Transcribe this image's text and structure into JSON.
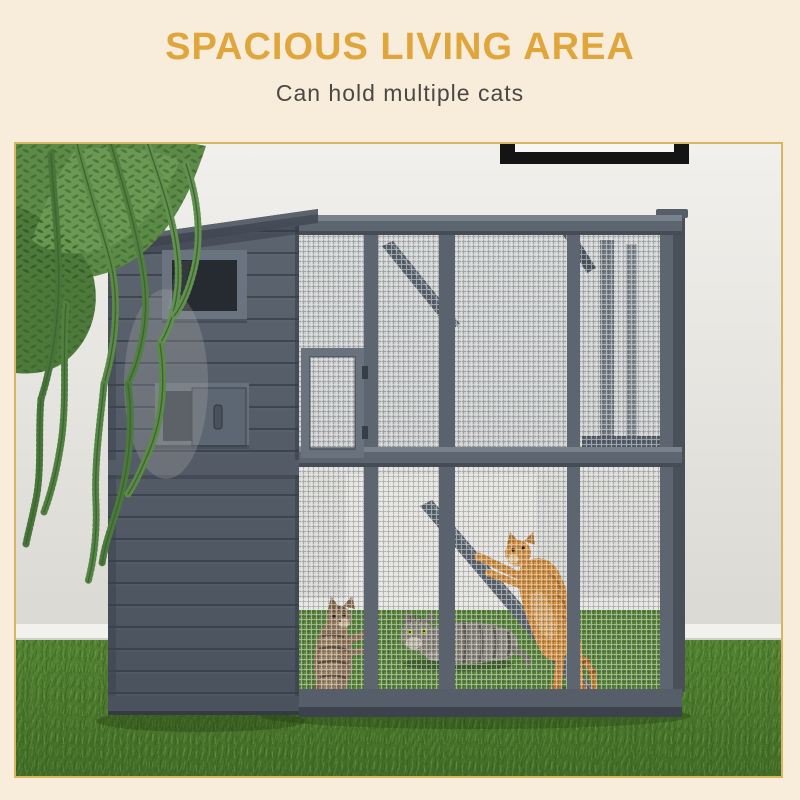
{
  "header": {
    "title": "SPACIOUS LIVING AREA",
    "subtitle": "Can hold multiple cats"
  },
  "colors": {
    "background": "#F8EDDA",
    "title": "#E0A63C",
    "subtitle": "#4B4745",
    "photo_border": "#D9B562",
    "wall": "#E9E8E3",
    "baseboard": "#F2F1ED",
    "wood_gray": "#525A66",
    "roof_gray": "#434A54",
    "mesh_wire": "#B8BDC2",
    "grass_green": "#4E7C30",
    "plant_green": "#5C8A47",
    "picture_frame": "#141414",
    "cat_orange": "#D8913F",
    "cat_brown_tabby": "#97795B",
    "cat_gray_tabby": "#8D887A",
    "latch_brass": "#B5974F"
  },
  "photo": {
    "alt": "Gray wooden catio with wire-mesh run standing on artificial grass against a light wall; hanging fern at left, black picture frame at top right; inside are a tabby kitten standing upright, a gray tabby lying down, and an orange cat leaping onto a ramp."
  }
}
